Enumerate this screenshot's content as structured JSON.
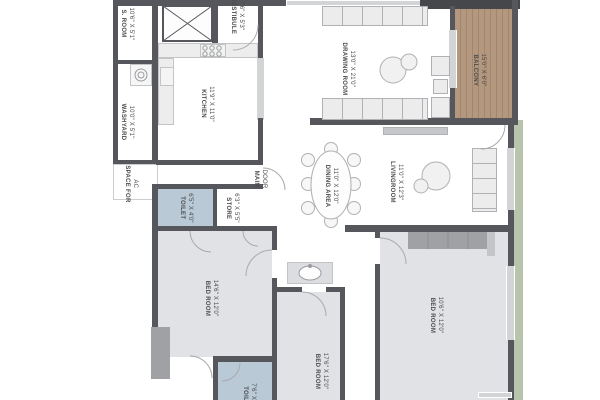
{
  "plan": {
    "type": "apartment-floor-plan",
    "rooms": [
      {
        "id": "s-room",
        "label": "S. ROOM",
        "dims": "10'6\" X 5'1\"",
        "x": 127,
        "y": 24
      },
      {
        "id": "washyard",
        "label": "WASHYARD",
        "dims": "10'0\" X 5'1\"",
        "x": 127,
        "y": 122
      },
      {
        "id": "space-for-ac",
        "label": "SPACE FOR",
        "dims": "AC",
        "x": 131,
        "y": 184
      },
      {
        "id": "vestibule",
        "label": "VESTIBULE",
        "dims": "7'6\" X 5'3\"",
        "x": 237,
        "y": 16
      },
      {
        "id": "kitchen",
        "label": "KITCHEN",
        "dims": "11'9\" X 11'0\"",
        "x": 207,
        "y": 104
      },
      {
        "id": "drawing-room",
        "label": "DRAWING ROOM",
        "dims": "13'0\" X 21'0\"",
        "x": 348,
        "y": 69
      },
      {
        "id": "balcony",
        "label": "BALCONY",
        "dims": "15'0\" X 6'0\"",
        "x": 479,
        "y": 70
      },
      {
        "id": "livingroom",
        "label": "LIVINGROOM",
        "dims": "11'0\" X 12'3\"",
        "x": 396,
        "y": 182
      },
      {
        "id": "dining-area",
        "label": "DINING AREA",
        "dims": "11'0\" X 12'0\"",
        "x": 331,
        "y": 186
      },
      {
        "id": "toilet-1",
        "label": "TOILET",
        "dims": "6'5\" X 4'0\"",
        "x": 186,
        "y": 208
      },
      {
        "id": "store",
        "label": "STORE",
        "dims": "6'3\" X 5'5\"",
        "x": 232,
        "y": 208
      },
      {
        "id": "bed-room-1",
        "label": "BED ROOM",
        "dims": "14'6\" X 12'0\"",
        "x": 211,
        "y": 298
      },
      {
        "id": "bed-room-2",
        "label": "BED ROOM",
        "dims": "17'6\" X 12'0\"",
        "x": 321,
        "y": 371
      },
      {
        "id": "bed-room-3",
        "label": "BED ROOM",
        "dims": "10'6\" X 12'0\"",
        "x": 436,
        "y": 315
      },
      {
        "id": "toilet-2",
        "label": "TOILET",
        "dims": "7'6\" X 5'5\"",
        "x": 249,
        "y": 398
      },
      {
        "id": "main-door",
        "label": "MAIN",
        "dims": "DOOR",
        "x": 260,
        "y": 179
      }
    ],
    "fixtures": [
      "lift-shaft",
      "stove",
      "kitchen-sink",
      "washing-machine",
      "wash-basin",
      "dining-table-8-seats",
      "sofa",
      "coffee-tables",
      "tv-unit",
      "lounge-chair",
      "wardrobe"
    ],
    "colors": {
      "wall": "#55575c",
      "wall_light": "#9fa1a5",
      "floor_bed": "#e0e2e5",
      "toilet": "#b9c9d6",
      "wood": "#b3977e",
      "wood_dark": "#a3876c",
      "green": "#b9c4ac",
      "counter": "#ededed",
      "furn_line": "#b0b1b4",
      "text": "#4b4b4b",
      "window": "#d3d4d6"
    }
  }
}
